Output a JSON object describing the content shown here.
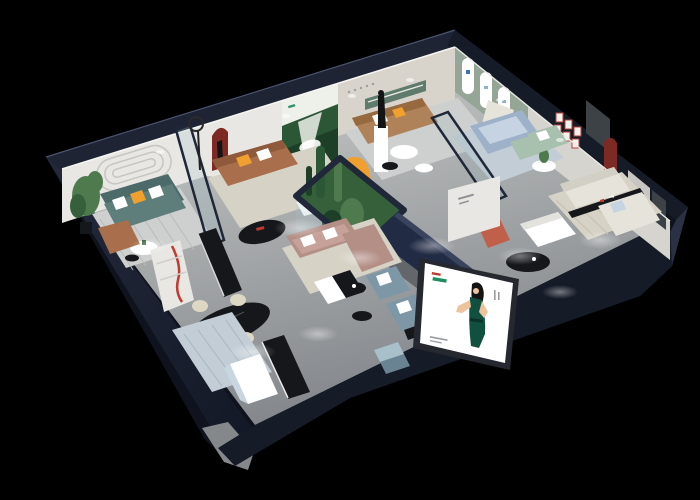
{
  "scene": {
    "description": "3D isometric cutaway render of a furniture showroom on a black background: dark navy exterior walls, grey floors, many furnished room vignettes (teal, brown, blue, ivory and mauve sofas), a glass cactus terrarium at the center, wall murals and arch niches, and an illuminated billboard showing a woman in a dark green dress mounted on the front wall",
    "background_color": "#000000",
    "text_note": "all printed text in the render (wall logos, posters, billboard captions) is too small to be legible"
  },
  "palette": {
    "bg": "#000000",
    "navy-top": "#2a3144",
    "navy": "#1e2433",
    "navy-dark": "#161b28",
    "navy-deep": "#0f131d",
    "beam-navy": "#222b44",
    "glass-frame": "#1f2738",
    "base-grey": "#85888b",
    "floor-light": "#d3d5d3",
    "floor-mid": "#a9acac",
    "corridor": "#7d8187",
    "wall-white": "#e8e7e3",
    "wall-grey": "#d6d4cf",
    "wall-beige": "#d8d4cb",
    "wall-shadow": "#bdbcb8",
    "sage": "#95a596",
    "sage-dark": "#5f7b6c",
    "forest": "#2c5737",
    "forest-dark": "#1d3f27",
    "mural-sky": "#eef0ea",
    "teal-sofa": "#5e7e7b",
    "teal-dark": "#4c6a69",
    "brown-sofa": "#a96f4c",
    "tan-sofa": "#b08259",
    "blue-sofa": "#9db1c8",
    "blue-light": "#c5d3e2",
    "slate": "#7e97a6",
    "slate-dark": "#6a8393",
    "mauve": "#b38f86",
    "mauve-light": "#c6a199",
    "ivory": "#e6e3da",
    "mint": "#a8c0ae",
    "coral": "#c0604b",
    "orange": "#f0a02e",
    "red-arch": "#7c2a23",
    "red-accent": "#c0392e",
    "table-black": "#16171b",
    "white": "#ffffff",
    "cream": "#ded7c4",
    "rug-grey": "#cdd0ce",
    "rug-beige": "#d6d2c6",
    "rug-blue": "#c2cdd6",
    "plant": "#4e7a4e",
    "plant-dark": "#35603a",
    "skin": "#edc39e",
    "dress": "#11503f",
    "hair": "#141414",
    "grey-door": "#c7c6c2",
    "window-dark": "#3c4246"
  }
}
